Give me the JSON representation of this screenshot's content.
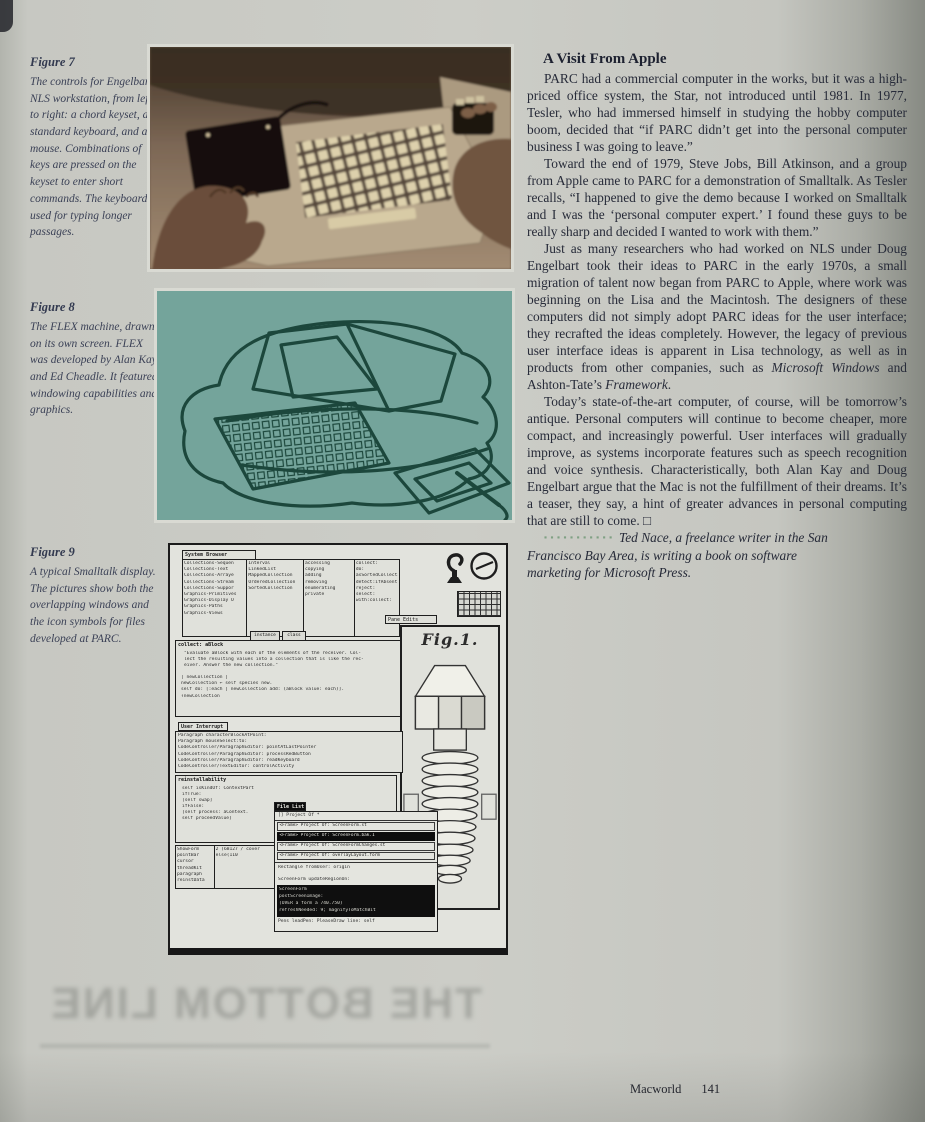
{
  "page": {
    "footer_magazine": "Macworld",
    "footer_page": "141",
    "bleed_text": "THE BOTTOM LINE"
  },
  "captions": {
    "fig7_title": "Figure 7",
    "fig7_body": "The controls for Engelbart's NLS workstation, from left to right: a chord keyset, a standard keyboard, and a mouse. Combinations of keys are pressed on the keyset to enter short commands. The keyboard is used for typing longer passages.",
    "fig8_title": "Figure 8",
    "fig8_body": "The FLEX machine, drawn on its own screen. FLEX was developed by Alan Kay and Ed Cheadle. It featured windowing capabilities and graphics.",
    "fig9_title": "Figure 9",
    "fig9_body": "A typical Smalltalk display. The pictures show both the overlapping windows and the icon symbols for files developed at PARC."
  },
  "article": {
    "heading": "A Visit From Apple",
    "p1": "PARC had a commercial computer in the works, but it was a high-priced office system, the Star, not introduced until 1981. In 1977, Tesler, who had immersed himself in studying the hobby computer boom, decided that “if PARC didn’t get into the personal computer business I was going to leave.”",
    "p2": "Toward the end of 1979, Steve Jobs, Bill Atkinson, and a group from Apple came to PARC for a demonstration of Smalltalk. As Tesler recalls, “I happened to give the demo because I worked on Smalltalk and I was the ‘personal computer expert.’ I found these guys to be really sharp and decided I wanted to work with them.”",
    "p3_runs": [
      {
        "t": "Just as many researchers who had worked on NLS under Doug Engelbart took their ideas to PARC in the early 1970s, a small migration of talent now began from PARC to Apple, where work was beginning on the Lisa and the Macintosh. The designers of these computers did not simply adopt PARC ideas for the user interface; they recrafted the ideas completely. However, the legacy of previous user interface ideas is apparent in Lisa technology, as well as in products from other companies, such as ",
        "i": false
      },
      {
        "t": "Microsoft Windows",
        "i": true
      },
      {
        "t": " and Ashton-Tate’s ",
        "i": false
      },
      {
        "t": "Framework",
        "i": true
      },
      {
        "t": ".",
        "i": false
      }
    ],
    "p4": "Today’s state-of-the-art computer, of course, will be tomorrow’s antique. Personal computers will continue to become cheaper, more compact, and increasingly powerful. User interfaces will gradually improve, as systems incorporate features such as speech recognition and voice synthesis. Characteristically, both Alan Kay and Doug Engelbart argue that the Mac is not the fulfillment of their dreams. It’s a teaser, they say, a hint of greater advances in personal computing that are still to come. □",
    "bio_dots": "▪▪▪▪▪▪▪▪▪▪▪",
    "bio": "Ted Nace, a freelance writer in the San Francisco Bay Area, is writing a book on software marketing for Microsoft Press."
  },
  "smalltalk": {
    "browser_title": "System Browser",
    "browser_col1": [
      "Collections-Sequen",
      "Collections-Text",
      "Collections-Arraye",
      "Collections-Stream",
      "Collections-Suppor",
      "Graphics-Primitives",
      "Graphics-Display O",
      "Graphics-Paths",
      "Graphics-Views"
    ],
    "browser_col2": [
      "Interval",
      "LinkedList",
      "MappedCollection",
      "OrderedCollection",
      "SortedCollection"
    ],
    "browser_col3": [
      "accessing",
      "copying",
      "adding",
      "removing",
      "enumerating",
      "private"
    ],
    "browser_col4": [
      "collect:",
      "do:",
      "asSortedCollection:",
      "detect:ifAbsent:",
      "reject:",
      "select:",
      "with:collect:"
    ],
    "browser_buttons": [
      "instance",
      "class"
    ],
    "fig1_tab": "Pane Edits",
    "fig1_label": "Fig.1.",
    "collect_title": "collect: aBlock",
    "collect_comment": [
      "\"Evaluate aBlock with each of the elements of the receiver. Col-",
      "lect the resulting values into a collection that is like the rec-",
      "eiver. Answer the new collection.\""
    ],
    "collect_code": [
      "| newCollection |",
      "newCollection ← self species new.",
      "self do: [:each | newCollection add: (aBlock value: each)].",
      "↑newCollection"
    ],
    "paragraph_tab": "User Interrupt",
    "paragraph_lines": [
      "Paragraph characterBlockAtPoint:",
      "Paragraph mouseSelect:to:",
      "CodeController/ParagraphEditor: pointAtLastPointer",
      "CodeController/ParagraphEditor: processRedButton",
      "CodeController/ParagraphEditor: readKeyboard",
      "CodeController/TextEditor: controlActivity"
    ],
    "reinstall_title": "reinstallability",
    "reinstall_lines": [
      "self isKindOf: ContextPart",
      "  ifTrue:",
      "    [self swap]",
      "  ifFalse:",
      "    [self process: aContext.",
      "     self proceedValue]"
    ],
    "sidebar_words": [
      "ShowForm",
      "pointBar",
      "cursor",
      "threadKit",
      "paragraph",
      "reinstData"
    ],
    "sidebar_note": [
      "2 (68127 / cover",
      "else(110"
    ],
    "filelist_title": "File List",
    "filelist_top_row": "[] Project Of *",
    "filelist_rows": [
      {
        "text": "<Frame> Project Of: ScreenForm.st",
        "inv": false
      },
      {
        "text": "<Frame> Project Of: ScreenForm.bak.1",
        "inv": true
      },
      {
        "text": "<Frame> Project Of: ScreenFormChanges.st",
        "inv": false
      },
      {
        "text": "<Frame> Project Of: overlayLayout.form",
        "inv": false
      }
    ],
    "filelist_mid": [
      "Rectangle fromUser: origin",
      "",
      "ScreenForm updateRegionOn:"
    ],
    "filelist_block": [
      "ScreenForm",
      "   postScreenImage:",
      "      (OVER a form a 740.750)",
      "   refreshNeeded: 9; magnifyToMatchBit"
    ],
    "filelist_bottom": "Pens leadPen: PleaseDraw line: self"
  },
  "colors": {
    "paper": "#c9cac3",
    "ink": "#272b39",
    "caption_ink": "#3b4156",
    "teal_background": "#74a49b",
    "sketch_line": "#1c473c",
    "accent_dots": "#7fa083",
    "sepia_photo": "#6d594a"
  }
}
